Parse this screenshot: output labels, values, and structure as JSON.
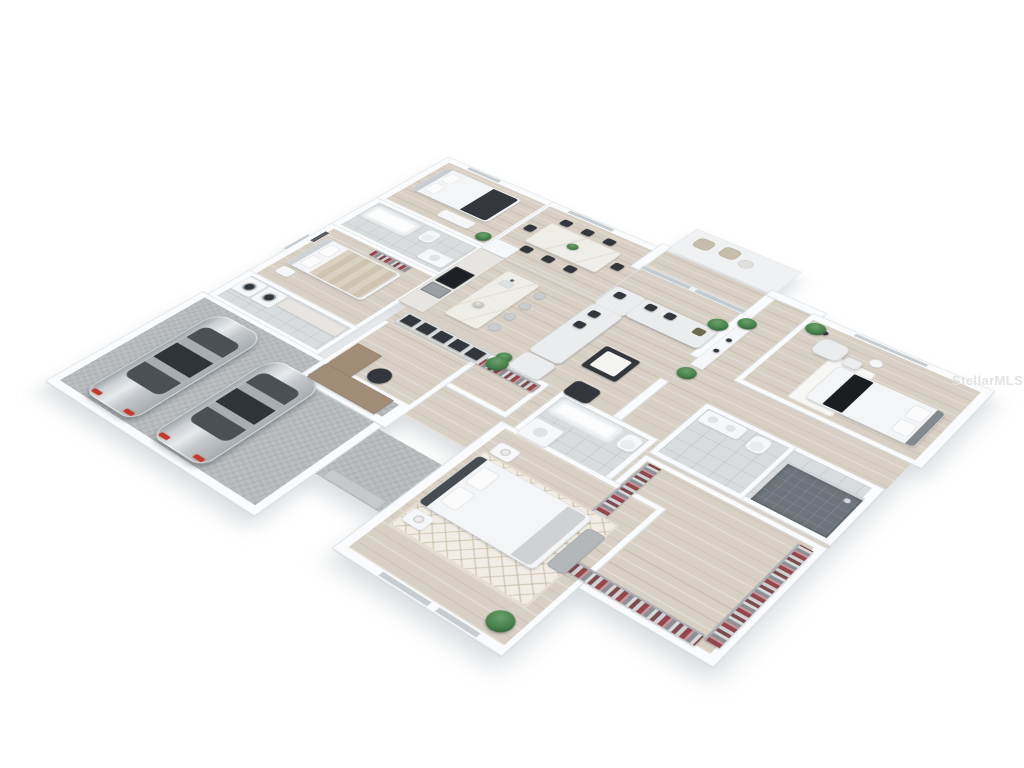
{
  "scene": {
    "type": "3d-floor-plan-rendering",
    "description": "Isometric 3D cutaway floor plan of a single-story home with attached two-car garage, open kitchen/dining/living area, four bedrooms, three bathrooms, office nook, laundry room and large walk-in closets.",
    "background_color": "#ffffff"
  },
  "watermark": {
    "text": "StellarMLS",
    "color": "#e3e3e3"
  },
  "palette": {
    "wall": "#fafbfc",
    "wall_edge": "#dfe3e6",
    "wood_floor": "#d8d0c5",
    "tile_floor": "#d9dcdd",
    "garage_floor": "#b7babb",
    "shower_tile": "#6d747b",
    "sofa_gray": "#ebeced",
    "dark_accent": "#33373b",
    "car_silver": "#ccd0d3",
    "taillight_red": "#c03a2e",
    "plant_green": "#47804c",
    "desk_brown": "#a18c77",
    "clothes_red": "#93474c",
    "rug_cream": "#f2ede4"
  },
  "vehicles": [
    {
      "type": "sedan",
      "color": "silver"
    },
    {
      "type": "sedan",
      "color": "silver"
    }
  ],
  "rooms": [
    {
      "name": "Bedroom 3",
      "items": [
        "bed with dark throw",
        "dresser",
        "plant",
        "window"
      ]
    },
    {
      "name": "Hall bathroom",
      "items": [
        "bathtub",
        "toilet",
        "vanity"
      ]
    },
    {
      "name": "Bedroom 2",
      "items": [
        "bed with tan bedding",
        "wall art",
        "clothes rack",
        "nightstand"
      ]
    },
    {
      "name": "Laundry room",
      "items": [
        "washer",
        "dryer",
        "counter"
      ]
    },
    {
      "name": "Garage",
      "items": [
        "two silver sedans"
      ]
    },
    {
      "name": "Dining area",
      "items": [
        "dining table",
        "eight chairs",
        "centerpiece",
        "window"
      ]
    },
    {
      "name": "Kitchen",
      "items": [
        "wall counter with cooktop and oven",
        "island with sink",
        "four bar stools",
        "flowers"
      ]
    },
    {
      "name": "Living room",
      "items": [
        "L-shaped sectional sofa with pillows",
        "coffee table",
        "accent chair",
        "potted plants",
        "sliding glass doors to patio"
      ]
    },
    {
      "name": "Hallway",
      "items": [
        "console table",
        "potted plants",
        "sideboard cabinets"
      ]
    },
    {
      "name": "Bedroom 4",
      "items": [
        "bed with black runner",
        "lounge chair with ottoman",
        "side table",
        "floor lamp",
        "plant",
        "rug",
        "window"
      ]
    },
    {
      "name": "Master bathroom",
      "items": [
        "double vanity",
        "toilet"
      ]
    },
    {
      "name": "Shower room",
      "items": [
        "dark tiled walk-in shower with glass"
      ]
    },
    {
      "name": "Bathroom 3",
      "items": [
        "bathtub",
        "toilet",
        "vanity"
      ]
    },
    {
      "name": "Closet",
      "items": [
        "clothes rack"
      ]
    },
    {
      "name": "Walk-in closet",
      "items": [
        "U-shaped clothes racks with hanging garments"
      ]
    },
    {
      "name": "Primary bedroom",
      "items": [
        "bed with dark headboard",
        "foot bench",
        "diamond-pattern rug",
        "two nightstands with lamps",
        "plant",
        "windows"
      ]
    },
    {
      "name": "Office nook",
      "items": [
        "L-shaped desk",
        "office chair",
        "cabinet sideboard",
        "plant"
      ]
    },
    {
      "name": "Entry porch",
      "items": [
        "concrete landing",
        "step"
      ]
    },
    {
      "name": "Patio",
      "items": [
        "outdoor chairs",
        "outdoor table"
      ]
    }
  ]
}
